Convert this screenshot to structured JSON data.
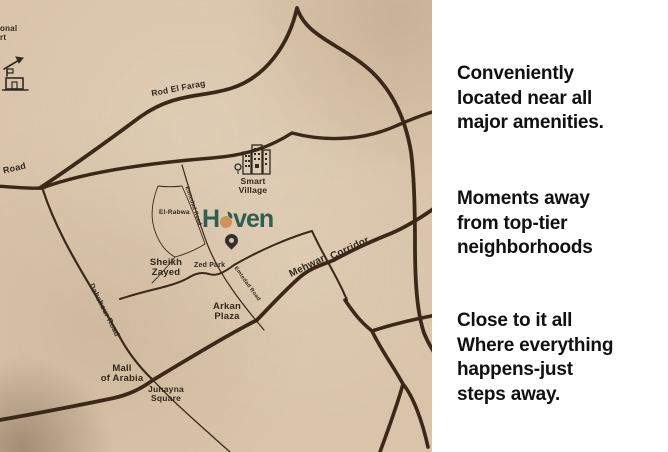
{
  "map": {
    "corner_fragment": "onal\nrt",
    "edge_road_fragment": "Road",
    "roads": {
      "rod_el_farag": "Rod El Farag",
      "mehwar": "Mehwar",
      "corridor": "Corridor",
      "dahshour": "Dahshour Road",
      "emtedad_upper": "Emtedad Road",
      "emtedad_lower": "Emtedad Road"
    },
    "places": {
      "smart_village": "Smart\nVillage",
      "el_rabwa": "El-Rabwa",
      "sheikh_zayed": "Sheikh\nZayed",
      "zed_park": "Zed Park",
      "arkan_plaza": "Arkan\nPlaza",
      "mall_of_arabia": "Mall\nof Arabia",
      "juhayna_square": "Juhayna\nSquare"
    },
    "logo": {
      "left": "H",
      "right": "ven"
    },
    "icons": {
      "airport": "airport-icon",
      "smart_village": "buildings-icon",
      "haven_pin": "location-pin-icon",
      "logo_dot": "sun-dot-icon"
    },
    "colors": {
      "paper": "#d9c4aa",
      "road": "#3b2817",
      "logo_green": "#2e5f50",
      "logo_orange": "#cf9257",
      "label": "#33281a"
    }
  },
  "panel": {
    "paragraphs": [
      {
        "text": "Conveniently\nlocated near all\nmajor amenities."
      },
      {
        "text": "Moments away\nfrom top-tier\nneighborhoods"
      },
      {
        "text": "Close to it all\nWhere everything\nhappens-just\nsteps away."
      }
    ],
    "colors": {
      "background": "#ffffff",
      "text": "#101010"
    }
  }
}
